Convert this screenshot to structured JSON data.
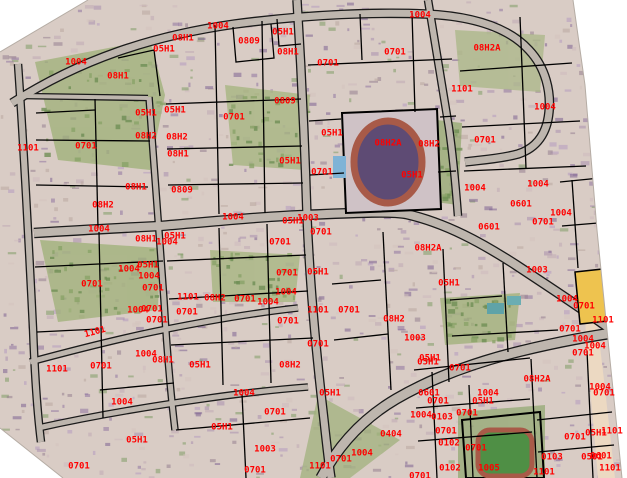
{
  "map": {
    "overlay_type": "cadastral-parcel-codes",
    "label_color": "#ff0000",
    "boundary_color": "#000000",
    "road_color": "#beb6ae",
    "vegetation_color": "#9db077",
    "track_color": "#a85a48",
    "highlight_parcel_color": "#eec34f",
    "features": [
      "aerial-photo-base",
      "road-network",
      "parcel-boundaries",
      "running-track-stadium",
      "swimming-pool",
      "football-field",
      "orange-highlighted-parcel"
    ],
    "parcel_labels": [
      {
        "text": "1004",
        "x": 76,
        "y": 62
      },
      {
        "text": "08H1",
        "x": 118,
        "y": 76
      },
      {
        "text": "05H1",
        "x": 164,
        "y": 49
      },
      {
        "text": "08H1",
        "x": 183,
        "y": 38
      },
      {
        "text": "1004",
        "x": 218,
        "y": 26
      },
      {
        "text": "0809",
        "x": 249,
        "y": 41
      },
      {
        "text": "05H1",
        "x": 283,
        "y": 32
      },
      {
        "text": "08H1",
        "x": 288,
        "y": 52
      },
      {
        "text": "0701",
        "x": 328,
        "y": 63
      },
      {
        "text": "1004",
        "x": 420,
        "y": 15
      },
      {
        "text": "0701",
        "x": 395,
        "y": 52
      },
      {
        "text": "08H2A",
        "x": 487,
        "y": 48
      },
      {
        "text": "1101",
        "x": 462,
        "y": 89
      },
      {
        "text": "1004",
        "x": 545,
        "y": 107
      },
      {
        "text": "0809",
        "x": 285,
        "y": 101
      },
      {
        "text": "05H1",
        "x": 175,
        "y": 110
      },
      {
        "text": "05H1",
        "x": 146,
        "y": 113
      },
      {
        "text": "0701",
        "x": 234,
        "y": 117
      },
      {
        "text": "08H2",
        "x": 146,
        "y": 136
      },
      {
        "text": "08H2",
        "x": 177,
        "y": 137
      },
      {
        "text": "1101",
        "x": 28,
        "y": 148
      },
      {
        "text": "0701",
        "x": 86,
        "y": 146
      },
      {
        "text": "08H1",
        "x": 178,
        "y": 154
      },
      {
        "text": "05H1",
        "x": 332,
        "y": 133
      },
      {
        "text": "08H2A",
        "x": 388,
        "y": 143
      },
      {
        "text": "08H2",
        "x": 429,
        "y": 144
      },
      {
        "text": "0701",
        "x": 485,
        "y": 140
      },
      {
        "text": "05H1",
        "x": 290,
        "y": 161
      },
      {
        "text": "0701",
        "x": 322,
        "y": 172
      },
      {
        "text": "05H1",
        "x": 412,
        "y": 175
      },
      {
        "text": "08H1",
        "x": 136,
        "y": 187
      },
      {
        "text": "0809",
        "x": 182,
        "y": 190
      },
      {
        "text": "1004",
        "x": 475,
        "y": 188
      },
      {
        "text": "1004",
        "x": 538,
        "y": 184
      },
      {
        "text": "08H2",
        "x": 103,
        "y": 205
      },
      {
        "text": "0601",
        "x": 521,
        "y": 204
      },
      {
        "text": "1004",
        "x": 561,
        "y": 213
      },
      {
        "text": "1004",
        "x": 233,
        "y": 217
      },
      {
        "text": "1003",
        "x": 308,
        "y": 218
      },
      {
        "text": "05H1",
        "x": 293,
        "y": 221
      },
      {
        "text": "0701",
        "x": 543,
        "y": 222
      },
      {
        "text": "0601",
        "x": 489,
        "y": 227
      },
      {
        "text": "1004",
        "x": 99,
        "y": 229
      },
      {
        "text": "0701",
        "x": 321,
        "y": 232
      },
      {
        "text": "05H1",
        "x": 175,
        "y": 236
      },
      {
        "text": "08H1",
        "x": 146,
        "y": 239
      },
      {
        "text": "1004",
        "x": 167,
        "y": 242
      },
      {
        "text": "0701",
        "x": 280,
        "y": 242
      },
      {
        "text": "08H2A",
        "x": 428,
        "y": 248
      },
      {
        "text": "05H1",
        "x": 148,
        "y": 265
      },
      {
        "text": "1004",
        "x": 129,
        "y": 269
      },
      {
        "text": "1003",
        "x": 537,
        "y": 270
      },
      {
        "text": "05H1",
        "x": 318,
        "y": 272
      },
      {
        "text": "0701",
        "x": 287,
        "y": 273
      },
      {
        "text": "1004",
        "x": 149,
        "y": 276
      },
      {
        "text": "05H1",
        "x": 449,
        "y": 283
      },
      {
        "text": "0701",
        "x": 92,
        "y": 284
      },
      {
        "text": "0701",
        "x": 153,
        "y": 288
      },
      {
        "text": "1004",
        "x": 286,
        "y": 292
      },
      {
        "text": "1101",
        "x": 188,
        "y": 297
      },
      {
        "text": "08H2",
        "x": 215,
        "y": 298
      },
      {
        "text": "0701",
        "x": 245,
        "y": 299
      },
      {
        "text": "1004",
        "x": 567,
        "y": 299
      },
      {
        "text": "1004",
        "x": 268,
        "y": 302
      },
      {
        "text": "0701",
        "x": 584,
        "y": 306
      },
      {
        "text": "1004",
        "x": 138,
        "y": 310
      },
      {
        "text": "0701",
        "x": 152,
        "y": 309
      },
      {
        "text": "1101",
        "x": 318,
        "y": 310
      },
      {
        "text": "0701",
        "x": 349,
        "y": 310
      },
      {
        "text": "0701",
        "x": 187,
        "y": 312
      },
      {
        "text": "08H2",
        "x": 394,
        "y": 319
      },
      {
        "text": "0701",
        "x": 157,
        "y": 320
      },
      {
        "text": "1101",
        "x": 603,
        "y": 320
      },
      {
        "text": "0701",
        "x": 288,
        "y": 321
      },
      {
        "text": "0701",
        "x": 570,
        "y": 329
      },
      {
        "text": "1101",
        "x": 95,
        "y": 332,
        "rot": -15
      },
      {
        "text": "1003",
        "x": 415,
        "y": 338
      },
      {
        "text": "1004",
        "x": 583,
        "y": 339
      },
      {
        "text": "0701",
        "x": 318,
        "y": 344
      },
      {
        "text": "1004",
        "x": 595,
        "y": 346
      },
      {
        "text": "0701",
        "x": 583,
        "y": 353
      },
      {
        "text": "1004",
        "x": 146,
        "y": 354
      },
      {
        "text": "05H1",
        "x": 430,
        "y": 358
      },
      {
        "text": "08H1",
        "x": 163,
        "y": 360
      },
      {
        "text": "05H1",
        "x": 428,
        "y": 362
      },
      {
        "text": "08H2",
        "x": 290,
        "y": 365
      },
      {
        "text": "05H1",
        "x": 200,
        "y": 365
      },
      {
        "text": "0701",
        "x": 101,
        "y": 366
      },
      {
        "text": "0701",
        "x": 460,
        "y": 368
      },
      {
        "text": "1101",
        "x": 57,
        "y": 369
      },
      {
        "text": "08H2A",
        "x": 537,
        "y": 379
      },
      {
        "text": "1004",
        "x": 600,
        "y": 387
      },
      {
        "text": "0601",
        "x": 429,
        "y": 393
      },
      {
        "text": "1004",
        "x": 244,
        "y": 393
      },
      {
        "text": "05H1",
        "x": 330,
        "y": 393
      },
      {
        "text": "1004",
        "x": 488,
        "y": 393
      },
      {
        "text": "0701",
        "x": 604,
        "y": 393
      },
      {
        "text": "0701",
        "x": 438,
        "y": 401
      },
      {
        "text": "05H1",
        "x": 483,
        "y": 401
      },
      {
        "text": "1004",
        "x": 122,
        "y": 402
      },
      {
        "text": "0701",
        "x": 275,
        "y": 412
      },
      {
        "text": "0701",
        "x": 467,
        "y": 413
      },
      {
        "text": "1004",
        "x": 421,
        "y": 415
      },
      {
        "text": "0103",
        "x": 442,
        "y": 417
      },
      {
        "text": "05H1",
        "x": 222,
        "y": 427
      },
      {
        "text": "0701",
        "x": 446,
        "y": 431
      },
      {
        "text": "1101",
        "x": 612,
        "y": 431
      },
      {
        "text": "05H1",
        "x": 596,
        "y": 433
      },
      {
        "text": "0404",
        "x": 391,
        "y": 434
      },
      {
        "text": "0701",
        "x": 575,
        "y": 437
      },
      {
        "text": "05H1",
        "x": 137,
        "y": 440
      },
      {
        "text": "0102",
        "x": 449,
        "y": 443
      },
      {
        "text": "0701",
        "x": 476,
        "y": 448
      },
      {
        "text": "1003",
        "x": 265,
        "y": 449
      },
      {
        "text": "1004",
        "x": 362,
        "y": 453
      },
      {
        "text": "0103",
        "x": 552,
        "y": 457
      },
      {
        "text": "0501",
        "x": 592,
        "y": 457
      },
      {
        "text": "0601",
        "x": 601,
        "y": 456
      },
      {
        "text": "0701",
        "x": 341,
        "y": 459
      },
      {
        "text": "1101",
        "x": 320,
        "y": 466
      },
      {
        "text": "0701",
        "x": 79,
        "y": 466
      },
      {
        "text": "0102",
        "x": 450,
        "y": 468
      },
      {
        "text": "1005",
        "x": 489,
        "y": 468
      },
      {
        "text": "1101",
        "x": 610,
        "y": 468
      },
      {
        "text": "0701",
        "x": 255,
        "y": 470
      },
      {
        "text": "0701",
        "x": 420,
        "y": 476
      },
      {
        "text": "1101",
        "x": 544,
        "y": 472
      }
    ]
  }
}
